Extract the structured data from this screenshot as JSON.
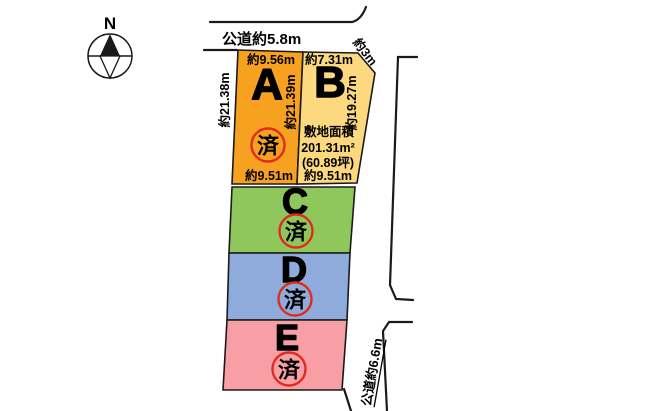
{
  "diagram": {
    "compass": {
      "label": "N"
    },
    "roads": {
      "top": "公道約5.8m",
      "northeast": "約3m",
      "southeast": "公道約6.6m"
    },
    "area_info": {
      "title": "敷地面積",
      "area_m2": "201.31m²",
      "area_tsubo": "(60.89坪)"
    },
    "stamp": {
      "label": "済",
      "color": "#e02b1d"
    },
    "ink_color": "#1a1a1a",
    "plots": [
      {
        "id": "A",
        "label": "A",
        "color": "#f7a120",
        "stamped": true,
        "dims": {
          "top": "約9.56m",
          "left": "約21.38m",
          "right": "約21.39m",
          "bottom": "約9.51m"
        }
      },
      {
        "id": "B",
        "label": "B",
        "color": "#fcd87f",
        "stamped": false,
        "dims": {
          "top": "約7.31m",
          "right": "約19.27m",
          "bottom": "約9.51m"
        }
      },
      {
        "id": "C",
        "label": "C",
        "color": "#8fc75c",
        "stamped": true,
        "dims": {}
      },
      {
        "id": "D",
        "label": "D",
        "color": "#8fabdc",
        "stamped": true,
        "dims": {}
      },
      {
        "id": "E",
        "label": "E",
        "color": "#f79fa5",
        "stamped": true,
        "dims": {}
      }
    ]
  }
}
